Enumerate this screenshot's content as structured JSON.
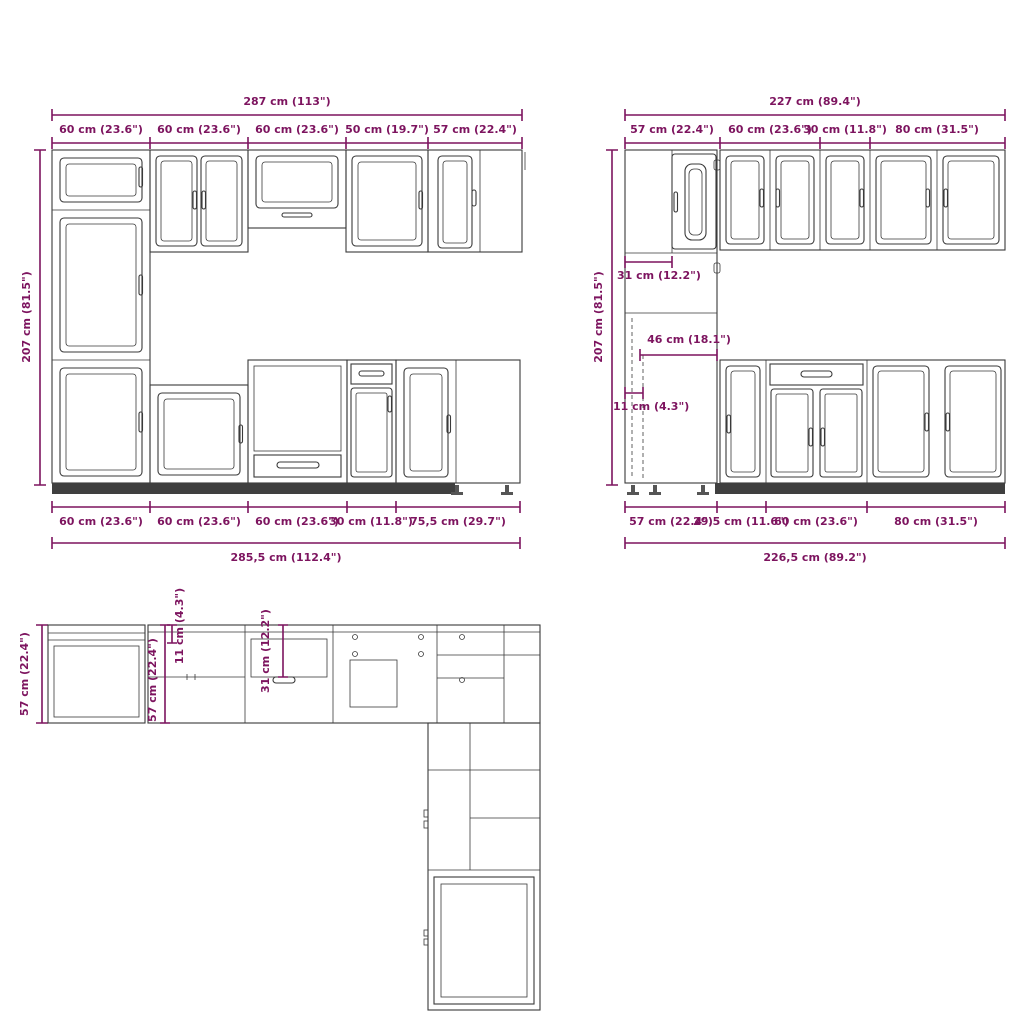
{
  "colors": {
    "dimension": "#7d145f",
    "line": "#3a3a3a",
    "background": "#ffffff"
  },
  "left_elevation": {
    "total_width_top": "287 cm (113\")",
    "height": "207 cm (81.5\")",
    "top_segments": [
      "60 cm (23.6\")",
      "60 cm (23.6\")",
      "60 cm (23.6\")",
      "50 cm (19.7\")",
      "57 cm (22.4\")"
    ],
    "bottom_segments": [
      "60 cm (23.6\")",
      "60 cm (23.6\")",
      "60 cm (23.6\")",
      "30 cm (11.8\")",
      "75,5 cm (29.7\")"
    ],
    "total_width_bottom": "285,5 cm (112.4\")"
  },
  "right_elevation": {
    "total_width_top": "227 cm (89.4\")",
    "height": "207 cm (81.5\")",
    "top_segments": [
      "57 cm (22.4\")",
      "60 cm (23.6\")",
      "30 cm (11.8\")",
      "80 cm (31.5\")"
    ],
    "inner_dimensions": {
      "upper": "31 cm (12.2\")",
      "middle": "46 cm (18.1\")",
      "lower": "11 cm (4.3\")"
    },
    "bottom_segments": [
      "57 cm (22.4\")",
      "29,5 cm (11.6\")",
      "60 cm (23.6\")",
      "80 cm (31.5\")"
    ],
    "total_width_bottom": "226,5 cm (89.2\")"
  },
  "plan_view": {
    "depth_left": "57 cm (22.4\")",
    "depth_inner": "57 cm (22.4\")",
    "offset_small": "11 cm (4.3\")",
    "offset_mid": "31 cm (12.2\")"
  }
}
